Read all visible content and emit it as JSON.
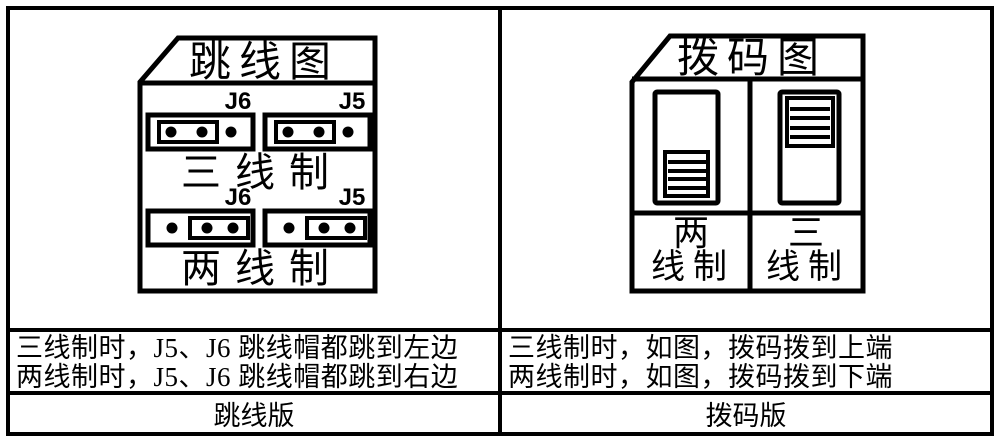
{
  "colors": {
    "ink": "#000000",
    "paper": "#ffffff"
  },
  "jumper_panel": {
    "title": "跳线图",
    "three_wire": {
      "j6_label": "J6",
      "j5_label": "J5",
      "caption": "三线制"
    },
    "two_wire": {
      "j6_label": "J6",
      "j5_label": "J5",
      "caption": "两线制"
    },
    "note_line1": "三线制时，J5、J6 跳线帽都跳到左边",
    "note_line2": "两线制时，J5、J6 跳线帽都跳到右边",
    "footer": "跳线版"
  },
  "dip_panel": {
    "title": "拨码图",
    "two_wire_label_top": "两",
    "two_wire_label_bottom": "线制",
    "three_wire_label_top": "三",
    "three_wire_label_bottom": "线制",
    "note_line1": "三线制时，如图，拨码拨到上端",
    "note_line2": "两线制时，如图，拨码拨到下端",
    "footer": "拨码版"
  }
}
